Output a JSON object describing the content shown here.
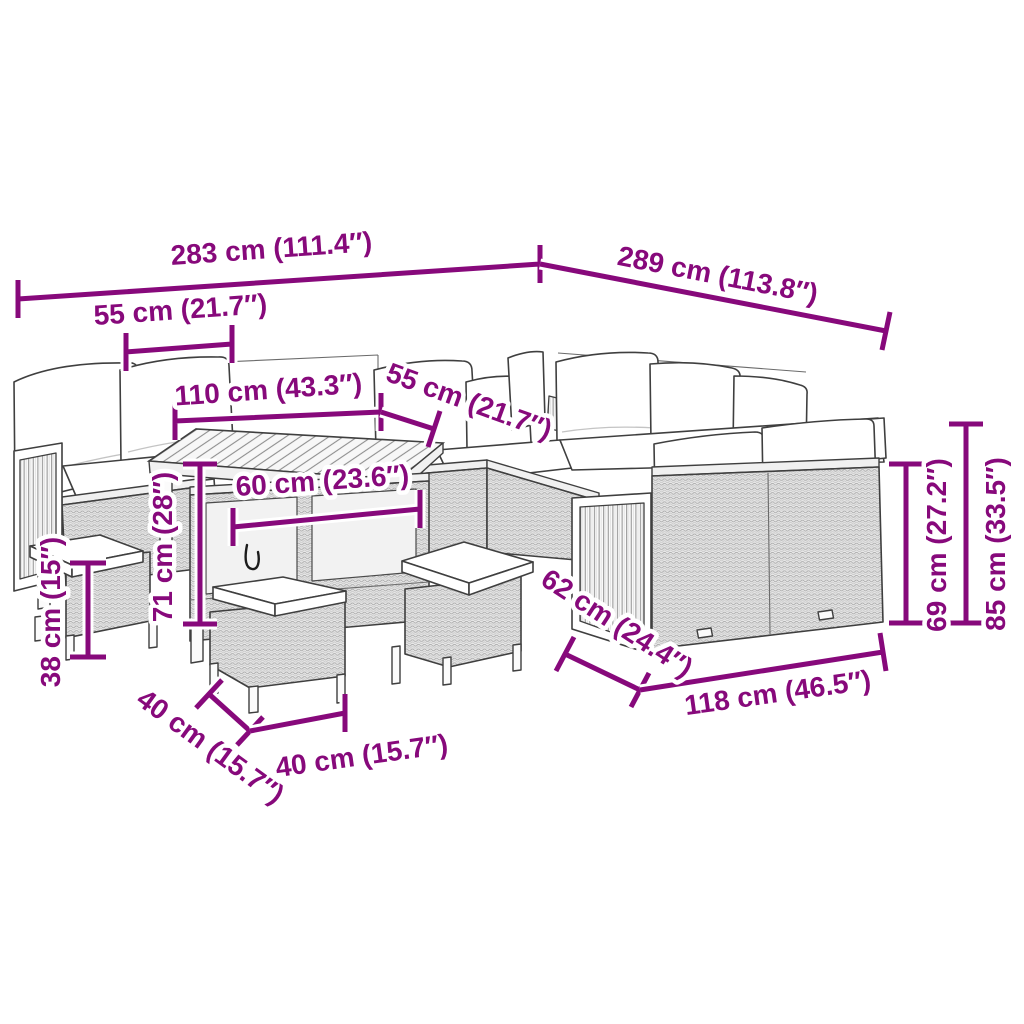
{
  "diagram": {
    "type": "product-dimension-line-art",
    "background": "#ffffff",
    "accent_color": "#87097b",
    "subject": "garden lounge set with table and stools",
    "dims": [
      {
        "name": "overall-width-left",
        "label": "283 cm (111.4″)"
      },
      {
        "name": "overall-width-right",
        "label": "289 cm (113.8″)"
      },
      {
        "name": "seat-width-left",
        "label": "55 cm (21.7″)"
      },
      {
        "name": "table-length",
        "label": "110 cm (43.3″)"
      },
      {
        "name": "seat-width-corner",
        "label": "55 cm (21.7″)"
      },
      {
        "name": "table-width",
        "label": "60 cm (23.6″)"
      },
      {
        "name": "table-height",
        "label": "71 cm (28″)"
      },
      {
        "name": "stool-height",
        "label": "38 cm (15″)"
      },
      {
        "name": "stool-depth",
        "label": "40 cm (15.7″)"
      },
      {
        "name": "stool-width",
        "label": "40 cm (15.7″)"
      },
      {
        "name": "sofa-depth",
        "label": "62 cm (24.4″)"
      },
      {
        "name": "sofa-section-width",
        "label": "118 cm (46.5″)"
      },
      {
        "name": "back-height",
        "label": "69 cm (27.2″)"
      },
      {
        "name": "total-height",
        "label": "85 cm (33.5″)"
      }
    ]
  }
}
